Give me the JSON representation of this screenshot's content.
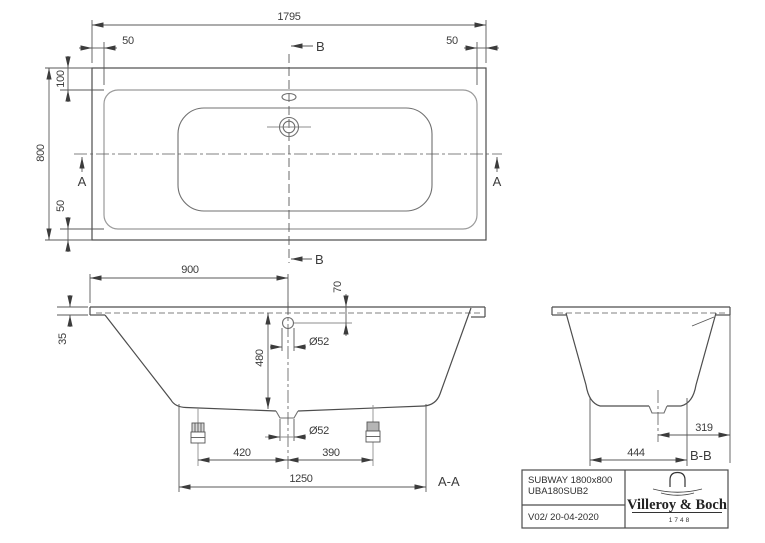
{
  "views": {
    "plan": {
      "dim_overall_length": "1795",
      "dim_rim_left": "50",
      "dim_rim_right": "50",
      "dim_rim_head": "100",
      "dim_overall_width": "800",
      "dim_rim_foot": "50",
      "marker_b_top": "B",
      "marker_b_bottom": "B",
      "marker_a_left": "A",
      "marker_a_right": "A"
    },
    "section_aa": {
      "dim_overflow_from_end": "900",
      "dim_overflow_below_rim": "70",
      "dim_rim_height": "35",
      "dim_inner_depth": "480",
      "dim_overflow_diameter": "Ø52",
      "dim_drain_diameter": "Ø52",
      "dim_foot_left_to_drain": "420",
      "dim_drain_to_foot_right": "390",
      "dim_base_length": "1250",
      "label": "A-A"
    },
    "section_bb": {
      "dim_base_width": "444",
      "dim_drain_offset": "319",
      "label": "B-B"
    }
  },
  "title_block": {
    "product_name": "SUBWAY 1800x800",
    "article_number": "UBA180SUB2",
    "version_date": "V02/ 20-04-2020",
    "brand_name": "Villeroy & Boch",
    "brand_year": "1748"
  }
}
